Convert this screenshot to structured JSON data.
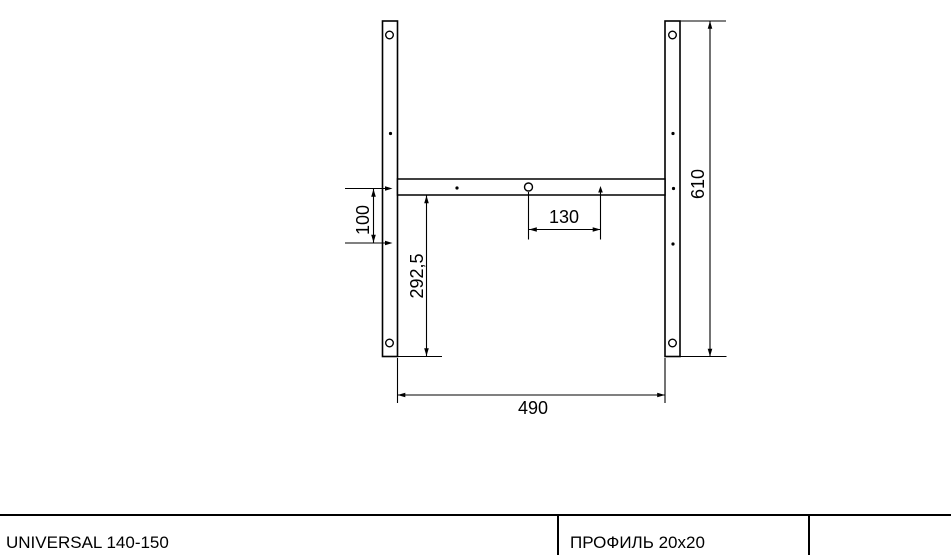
{
  "dimensions": {
    "d100": "100",
    "d292_5": "292,5",
    "d130": "130",
    "d490": "490",
    "d610": "610"
  },
  "title_block": {
    "model": "UNIVERSAL 140-150",
    "profile": "ПРОФИЛЬ 20x20"
  },
  "colors": {
    "line": "#000000",
    "background": "#ffffff"
  }
}
